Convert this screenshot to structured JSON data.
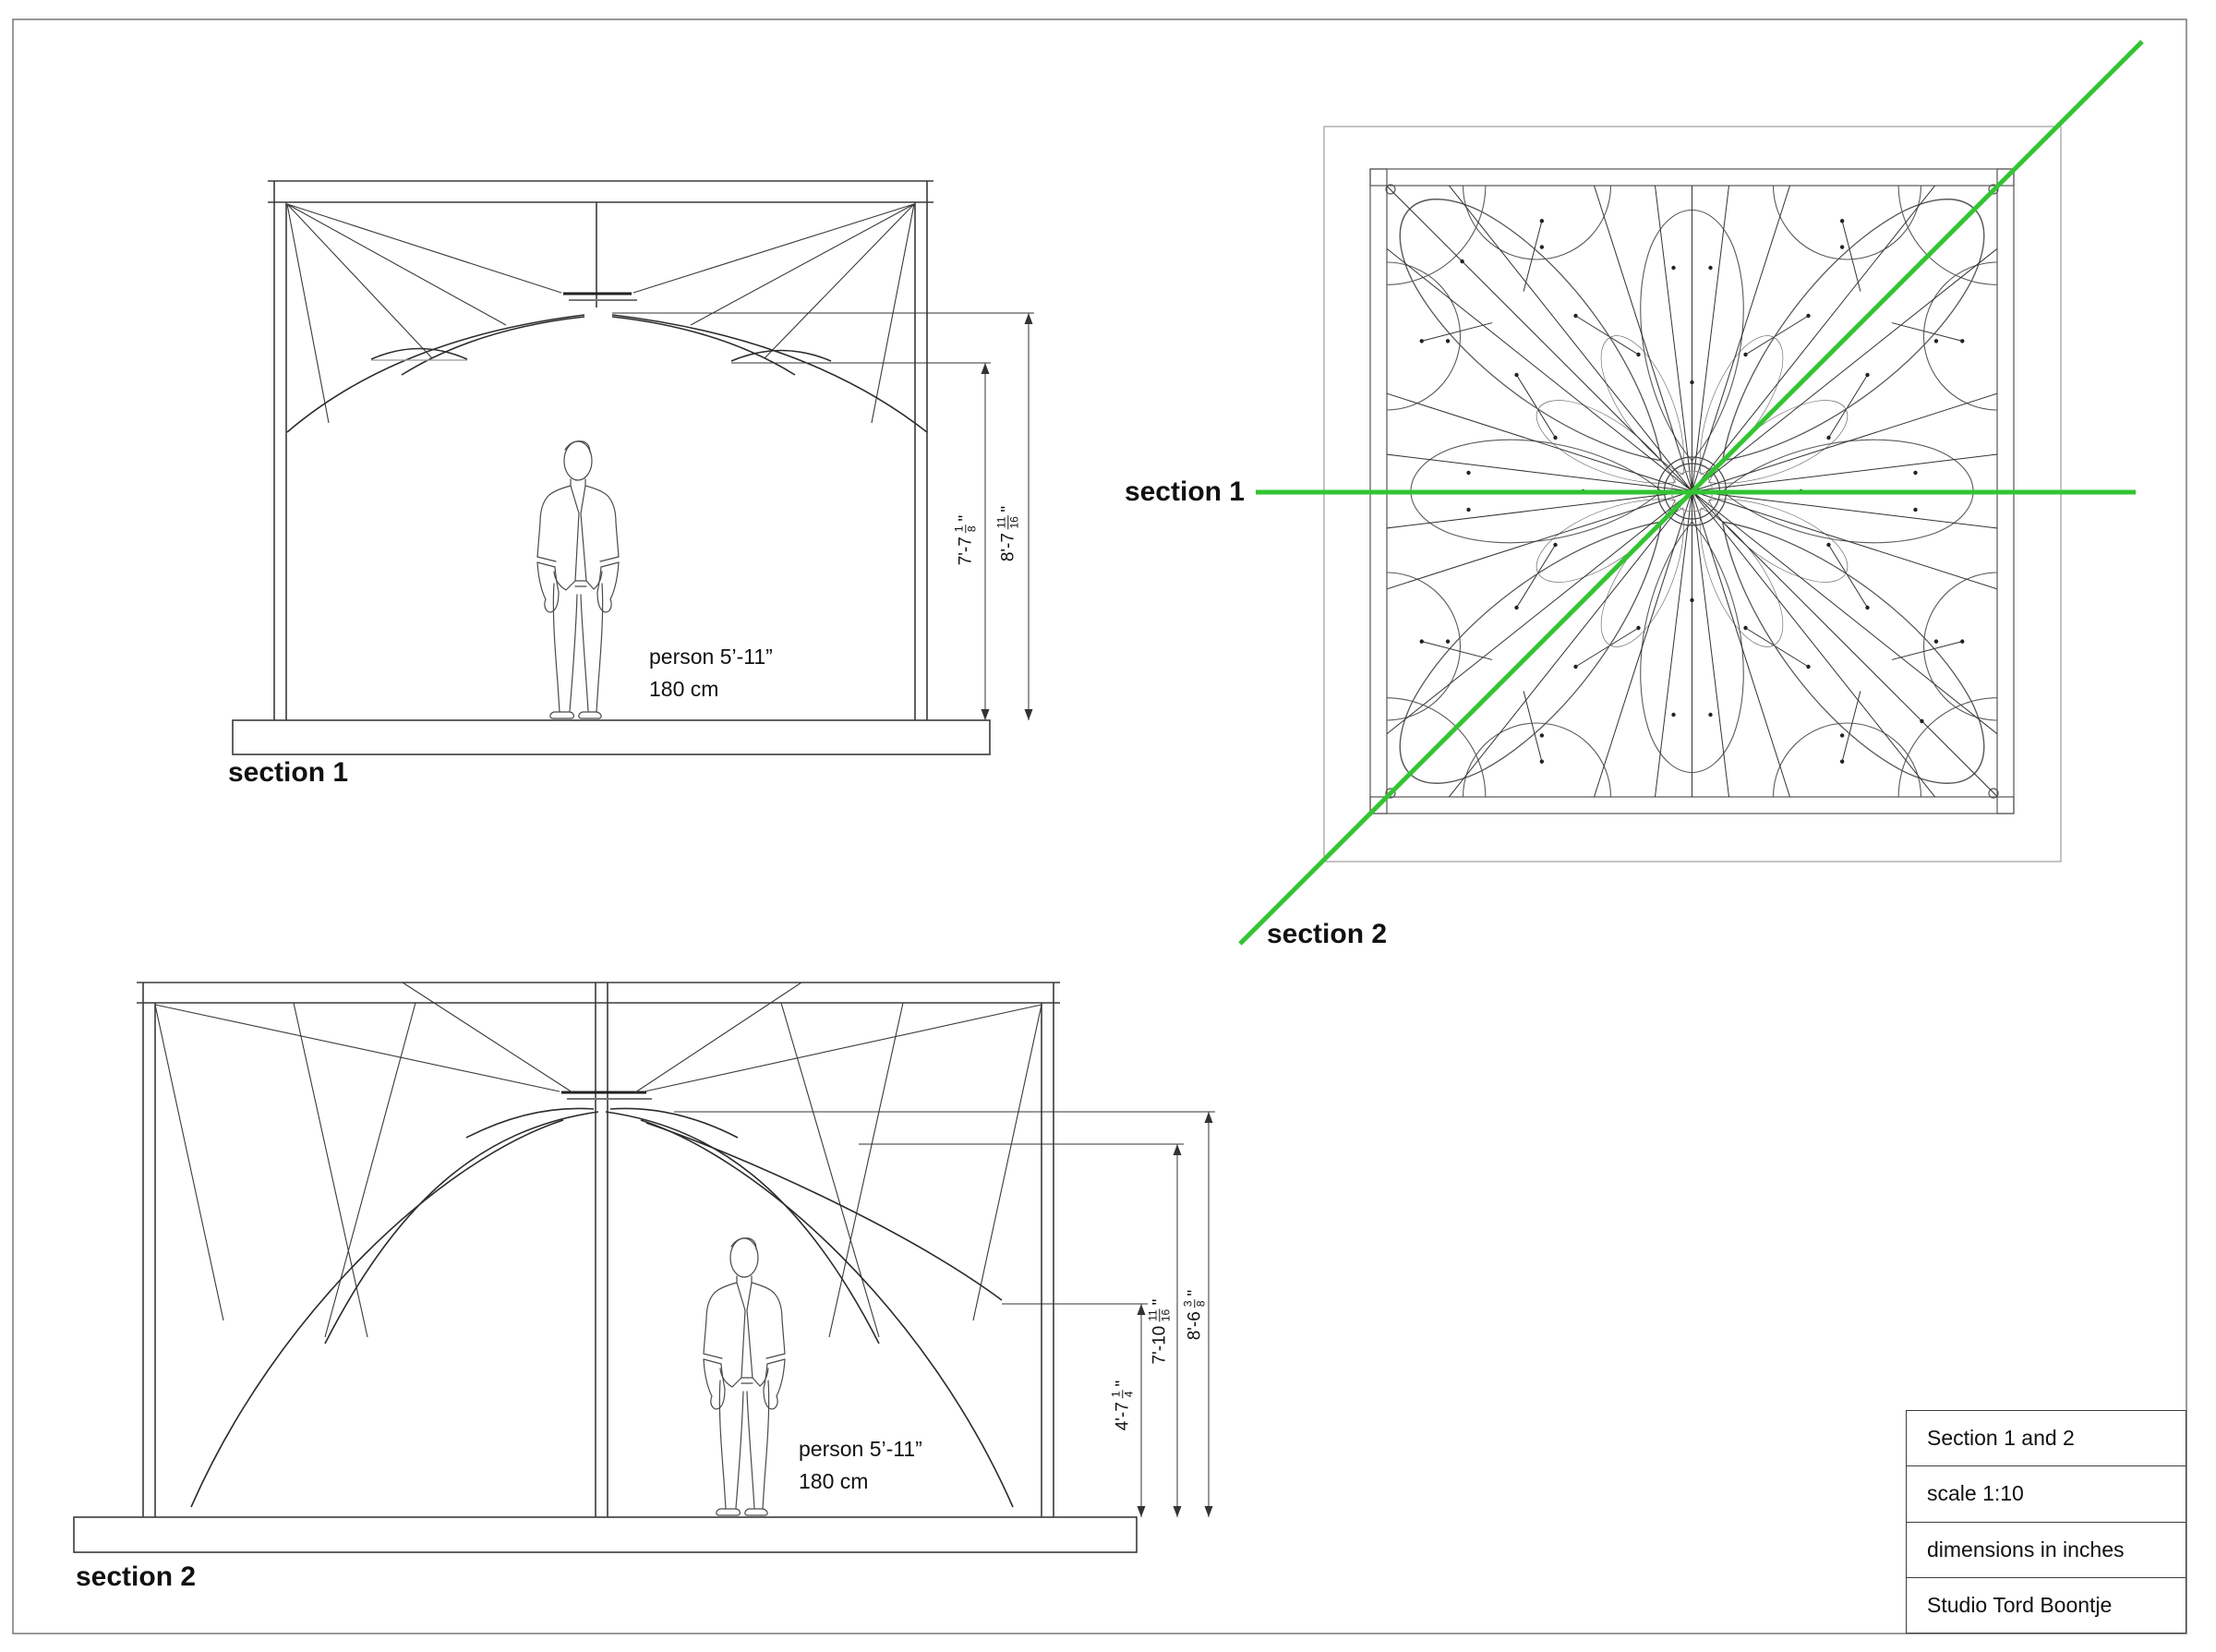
{
  "colors": {
    "section_cut_green": "#33c433",
    "structure_line": "#3a3a3a",
    "pattern_line": "#5a5a5a"
  },
  "drawings": {
    "section1": {
      "caption": "section 1",
      "person": {
        "line1": "person 5’-11”",
        "line2": "180 cm"
      },
      "dims": [
        {
          "whole": "7'-7",
          "num": "1",
          "den": "8",
          "unit": "\""
        },
        {
          "whole": "8'-7",
          "num": "11",
          "den": "16",
          "unit": "\""
        }
      ]
    },
    "section2": {
      "caption": "section 2",
      "person": {
        "line1": "person 5’-11”",
        "line2": "180 cm"
      },
      "dims": [
        {
          "whole": "4'-7",
          "num": "1",
          "den": "4",
          "unit": "\""
        },
        {
          "whole": "7'-10",
          "num": "11",
          "den": "16",
          "unit": "\""
        },
        {
          "whole": "8'-6",
          "num": "3",
          "den": "8",
          "unit": "\""
        }
      ]
    },
    "plan": {
      "section1_line_label": "section 1",
      "section2_line_label": "section 2"
    }
  },
  "title_block": {
    "rows": [
      {
        "label": "Section 1 and 2"
      },
      {
        "label": "scale 1:10"
      },
      {
        "label": "dimensions in inches"
      },
      {
        "label": "Studio Tord Boontje"
      }
    ]
  }
}
